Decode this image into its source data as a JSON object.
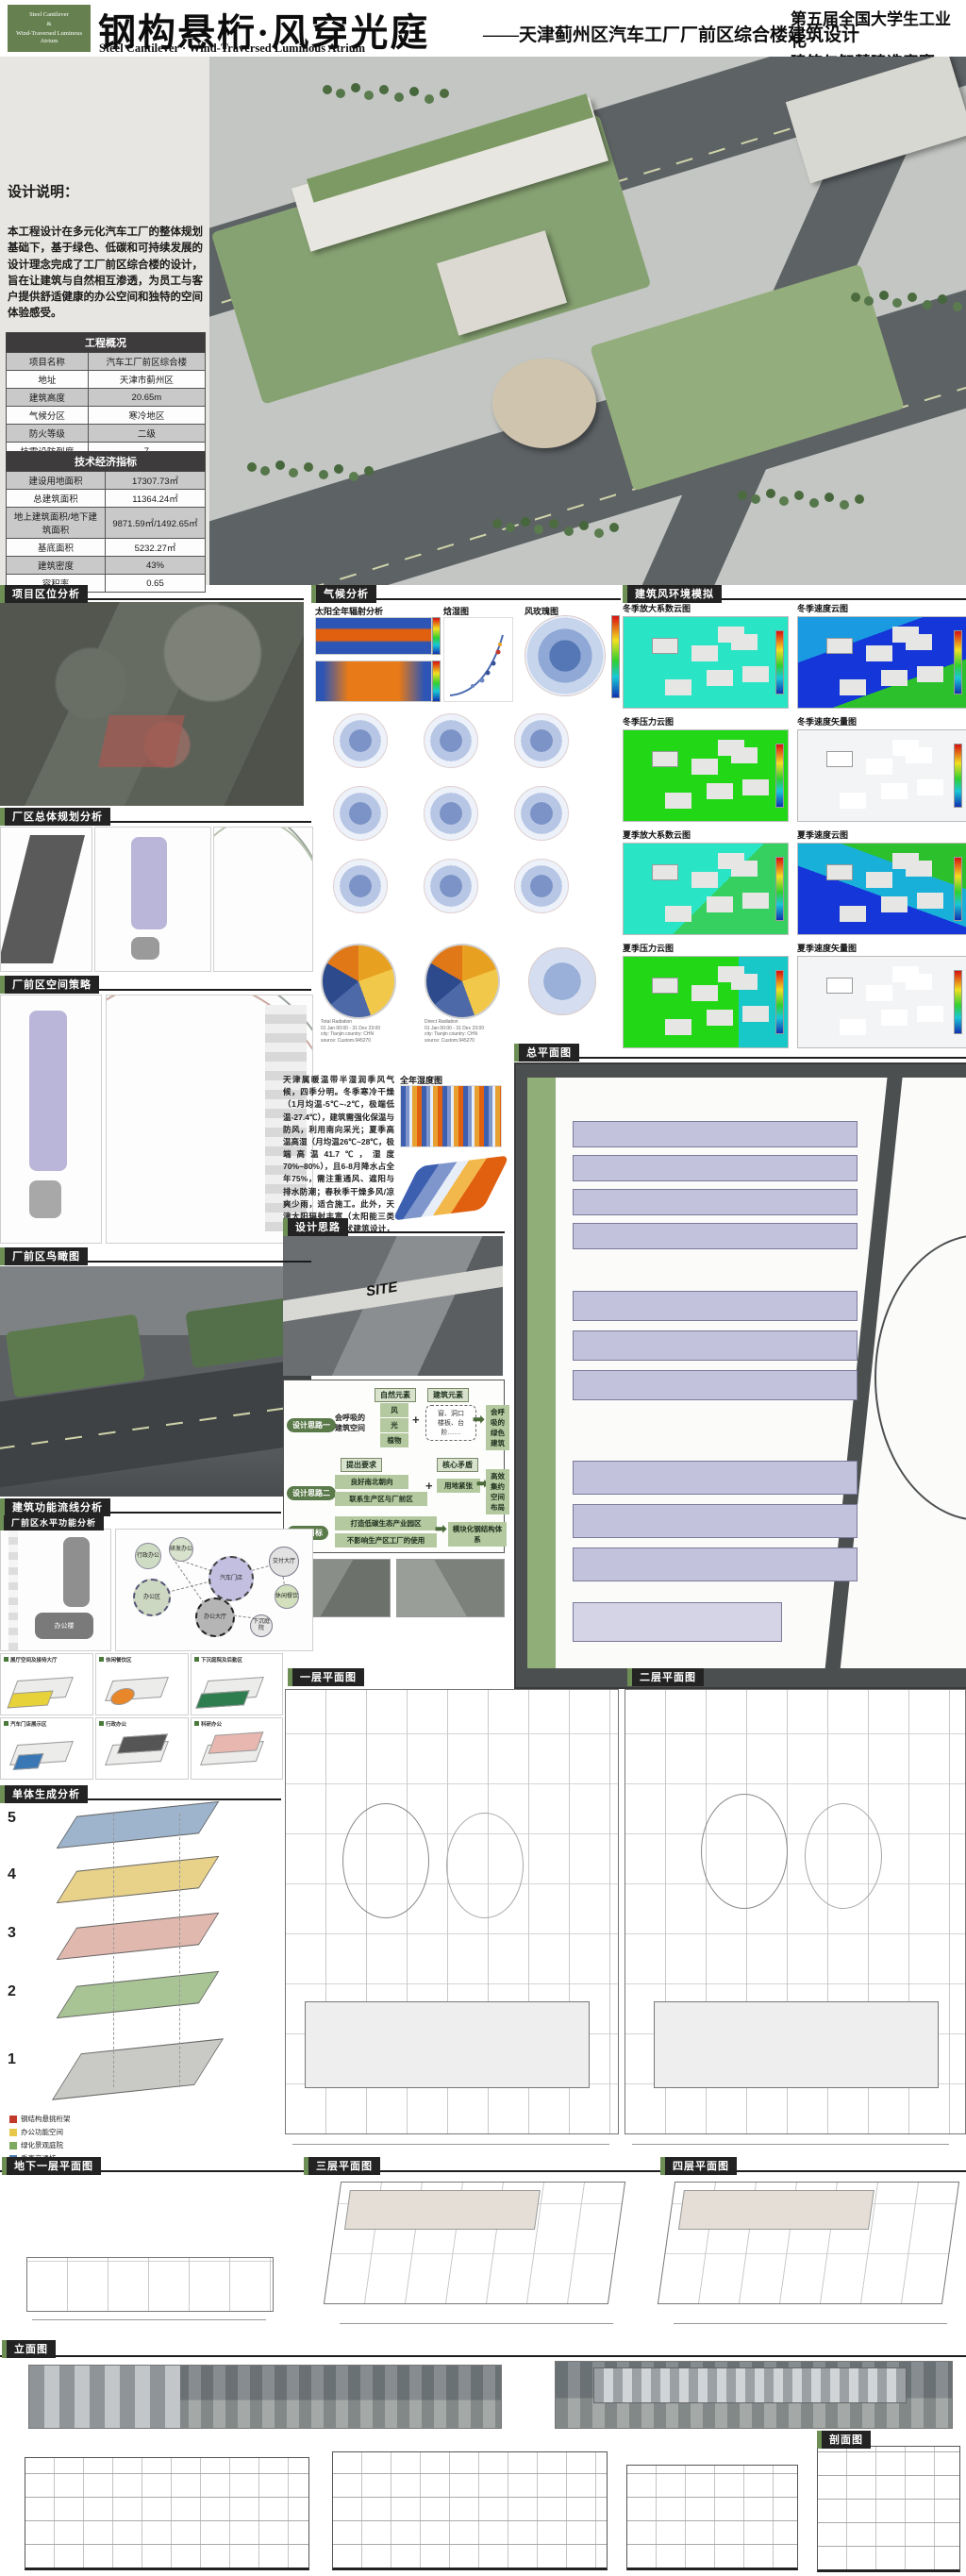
{
  "colors": {
    "accent_green": "#6d8f55",
    "badge_green": "#66814f",
    "chip_dark": "#232323"
  },
  "header": {
    "badge_line1": "Steel Cantilever",
    "badge_line2": "&",
    "badge_line3": "Wind-Traversed Luminous Atrium",
    "title_cn": "钢构悬桁·风穿光庭",
    "title_en": "Steel Cantilever · Wind-Traversed Luminous Atrium",
    "subtitle": "——天津蓟州区汽车工厂厂前区综合楼建筑设计",
    "competition_line1": "第五届全国大学生工业化",
    "competition_line2": "建筑与智慧建造竞赛"
  },
  "design_note": {
    "heading": "设计说明：",
    "body": "本工程设计在多元化汽车工厂的整体规划基础下，基于绿色、低碳和可持续发展的设计理念完成了工厂前区综合楼的设计，旨在让建筑与自然相互渗透，为员工与客户提供舒适健康的办公空间和独特的空间体验感受。"
  },
  "project_table": {
    "title": "工程概况",
    "rows": [
      {
        "label": "项目名称",
        "value": "汽车工厂前区综合楼"
      },
      {
        "label": "地址",
        "value": "天津市蓟州区"
      },
      {
        "label": "建筑高度",
        "value": "20.65m"
      },
      {
        "label": "气候分区",
        "value": "寒冷地区"
      },
      {
        "label": "防火等级",
        "value": "二级"
      },
      {
        "label": "抗震设防烈度",
        "value": "7"
      }
    ]
  },
  "tech_table": {
    "title": "技术经济指标",
    "rows": [
      {
        "label": "建设用地面积",
        "value": "17307.73㎡"
      },
      {
        "label": "总建筑面积",
        "value": "11364.24㎡"
      },
      {
        "label": "地上建筑面积/地下建筑面积",
        "value": "9871.59㎡/1492.65㎡"
      },
      {
        "label": "基底面积",
        "value": "5232.27㎡"
      },
      {
        "label": "建筑密度",
        "value": "43%"
      },
      {
        "label": "容积率",
        "value": "0.65"
      }
    ]
  },
  "sections": {
    "location": {
      "title": "项目区位分析"
    },
    "master_planning": {
      "title": "厂区总体规划分析"
    },
    "space_strategy": {
      "title": "厂前区空间策略"
    },
    "entry_view": {
      "title": "厂前区鸟瞰图"
    },
    "climate": {
      "title": "气候分析",
      "sub_radiation": "太阳全年辐射分析",
      "sub_psychro": "焓湿图",
      "sub_rose": "风玫瑰图",
      "dome_caption_total": "Total Radiation\n01 Jan 00:00 - 31 Dec 23:00\ncity: Tianjin  country: CHN\nsource: Custom.945270",
      "dome_caption_direct": "Direct Radiation\n01 Jan 00:00 - 31 Dec 23:00\ncity: Tianjin  country: CHN\nsource: Custom.945270",
      "humidity_title": "全年湿度图",
      "paragraph": "天津属暖温带半湿润季风气候，四季分明。冬季寒冷干燥（1月均温-5℃~-2℃，极端低温-27.4℃），建筑需强化保温与防风，利用南向采光；夏季高温高湿（月均温26℃~28℃，极端高温41.7℃，湿度70%~80%），且6-8月降水占全年75%，需注重通风、遮阳与排水防潮；春秋季干燥多风/凉爽少雨，适合施工。此外，天津太阳辐射丰富（太阳能三类地区），可结合光伏建筑设计，整体需平衡冬夏性能、利用自然能源并应对降水集中问题。"
    },
    "design_idea": {
      "title": "设计思路",
      "site_tag": "SITE",
      "flow": {
        "row1_tag": "设计思路一",
        "row1_src": "会呼吸的\n建筑空间",
        "nature_title": "自然元素",
        "nature_items": [
          "风",
          "光",
          "植物"
        ],
        "plus": "+",
        "arrow": "➡",
        "arch_title": "建筑元素",
        "arch_body": "窗、洞口\n楼板、台阶……",
        "row1_result": "会呼吸的\n绿色建筑",
        "row2_tag": "设计思路二",
        "req_title": "提出要求",
        "req_items": [
          "良好南北朝向",
          "联系生产区与厂前区"
        ],
        "conflict_title": "核心矛盾",
        "conflict_item": "用地紧张",
        "row2_result": "高效集约\n空间布局",
        "row3_tag": "设计目标",
        "goal_items": [
          "打造低碳生态产业园区",
          "不影响生产区工厂的使用"
        ],
        "row3_result": "模块化钢结构体系"
      }
    },
    "wind": {
      "title": "建筑风环境模拟",
      "panels": [
        {
          "label": "冬季放大系数云图"
        },
        {
          "label": "冬季速度云图"
        },
        {
          "label": "冬季压力云图"
        },
        {
          "label": "冬季速度矢量图"
        },
        {
          "label": "夏季放大系数云图"
        },
        {
          "label": "夏季速度云图"
        },
        {
          "label": "夏季压力云图"
        },
        {
          "label": "夏季速度矢量图"
        }
      ]
    },
    "master_plan": {
      "title": "总平面图"
    },
    "function": {
      "title": "建筑功能流线分析",
      "sub": "厂前区水平功能分析",
      "building_tag": "办公楼",
      "bubbles": [
        "汽车门店",
        "办公区",
        "办公大厅",
        "行政办公",
        "研发办公",
        "交付大厅",
        "休闲餐饮",
        "下沉庭院"
      ],
      "axon_captions": [
        "展厅空间及接待大厅",
        "休闲餐饮区",
        "下沉庭院及后勤区",
        "汽车门店展示区",
        "行政办公",
        "科研办公"
      ]
    },
    "massing": {
      "title": "单体生成分析",
      "steps": [
        "5",
        "4",
        "3",
        "2",
        "1"
      ],
      "legend": [
        {
          "color": "#c0392b",
          "label": "钢结构悬挑桁架"
        },
        {
          "color": "#e8c84a",
          "label": "办公功能空间"
        },
        {
          "color": "#7daa5f",
          "label": "绿化景观庭院"
        },
        {
          "color": "#4a78b0",
          "label": "垂直交通核"
        }
      ]
    },
    "plans": {
      "floor1": "一层平面图",
      "floor2": "二层平面图",
      "basement": "地下一层平面图",
      "floor3": "三层平面图",
      "floor4": "四层平面图"
    },
    "elevation": {
      "title": "立面图"
    },
    "section_dwg": {
      "title": "剖面图"
    }
  }
}
